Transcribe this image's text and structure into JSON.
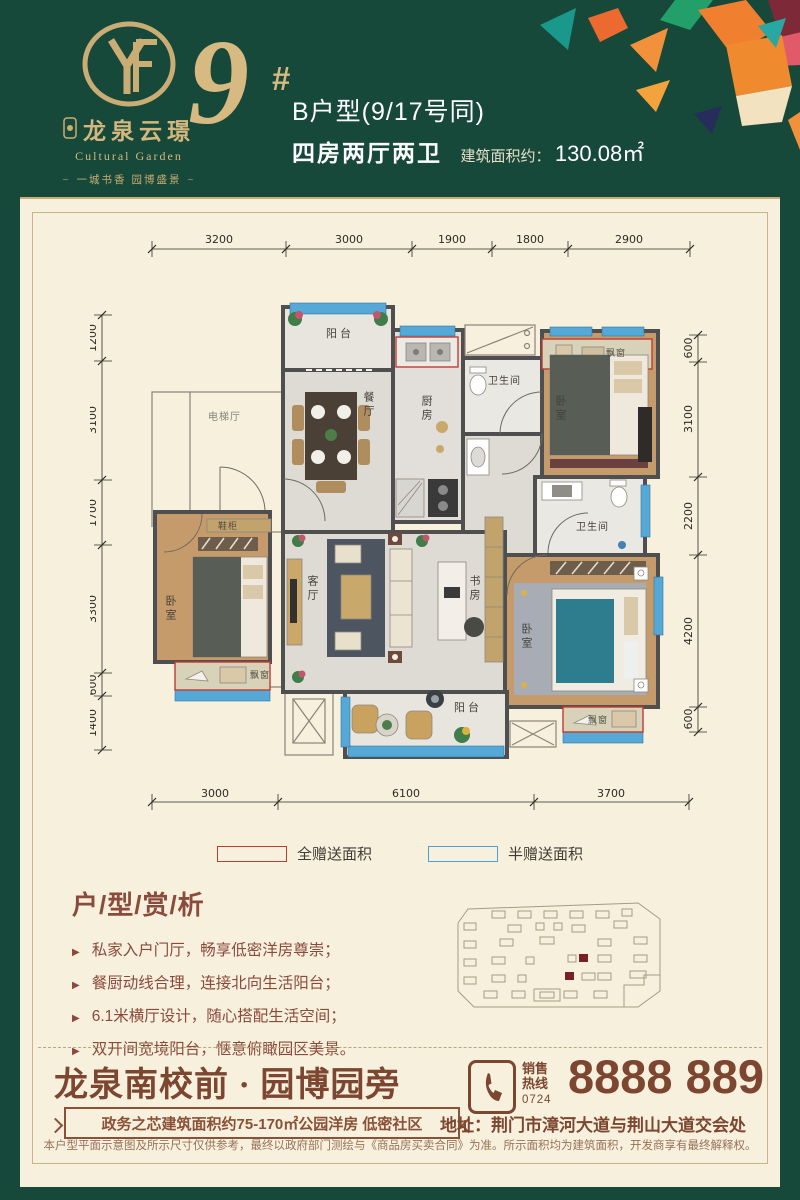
{
  "header": {
    "brand_cn": "龙泉云璟",
    "brand_en": "Cultural Garden",
    "tagline": "一城书香 园博盛景",
    "flourish": "~",
    "building_no": "9",
    "building_no_mark": "#",
    "unit_title": "B户型(9/17号同)",
    "layout": "四房两厅两卫",
    "area_label": "建筑面积约：",
    "area_value": "130.08㎡"
  },
  "plan": {
    "dims_top": [
      "3200",
      "3000",
      "1900",
      "1800",
      "2900"
    ],
    "dims_left": [
      "1200",
      "3100",
      "1700",
      "3300",
      "600",
      "1400"
    ],
    "dims_right": [
      "600",
      "3100",
      "2200",
      "4200",
      "600"
    ],
    "dims_bottom": [
      "3000",
      "6100",
      "3700"
    ],
    "labels": {
      "balcony_north": "阳台",
      "dining": "餐厅",
      "kitchen": "厨房",
      "bath_north": "卫生间",
      "bedroom_ne": "卧室",
      "bay_ne": "飘窗",
      "elevator_hall": "电梯厅",
      "shoe_cabinet": "鞋柜",
      "bedroom_west": "卧室",
      "bay_west": "飘窗",
      "living": "客厅",
      "study": "书房",
      "bath_mid": "卫生间",
      "bedroom_master": "卧室",
      "bay_master": "飘窗",
      "balcony_south": "阳台"
    }
  },
  "legend": {
    "full": {
      "label": "全赠送面积",
      "color": "#c23b33"
    },
    "half": {
      "label": "半赠送面积",
      "color": "#4aa3d8"
    }
  },
  "analysis": {
    "title": "户/型/赏/析",
    "bullet_glyph": "▶",
    "bullets": [
      "私家入户门厅，畅享低密洋房尊崇；",
      "餐厨动线合理，连接北向生活阳台；",
      "6.1米横厅设计，随心搭配生活空间；",
      "双开间宽境阳台，惬意俯瞰园区美景。"
    ]
  },
  "footer": {
    "headline": "龙泉南校前 · 园博园旁",
    "ribbon": "政务之芯建筑面积约75-170㎡公园洋房 低密社区",
    "hotline_label_top": "销售",
    "hotline_label_bottom": "热线",
    "hotline_area_code": "0724",
    "phone": "8888 889",
    "address": "地址：荆门市漳河大道与荆山大道交会处",
    "disclaimer": "本户型平面示意图及所示尺寸仅供参考，最终以政府部门测绘与《商品房买卖合同》为准。所示面积均为建筑面积，开发商享有最终解释权。"
  },
  "colors": {
    "green": "#17493a",
    "gold": "#d3b77e",
    "cream": "#f7f0dc",
    "brown": "#7c4631",
    "red_annotation": "#c23b33",
    "blue_annotation": "#4aa3d8"
  }
}
